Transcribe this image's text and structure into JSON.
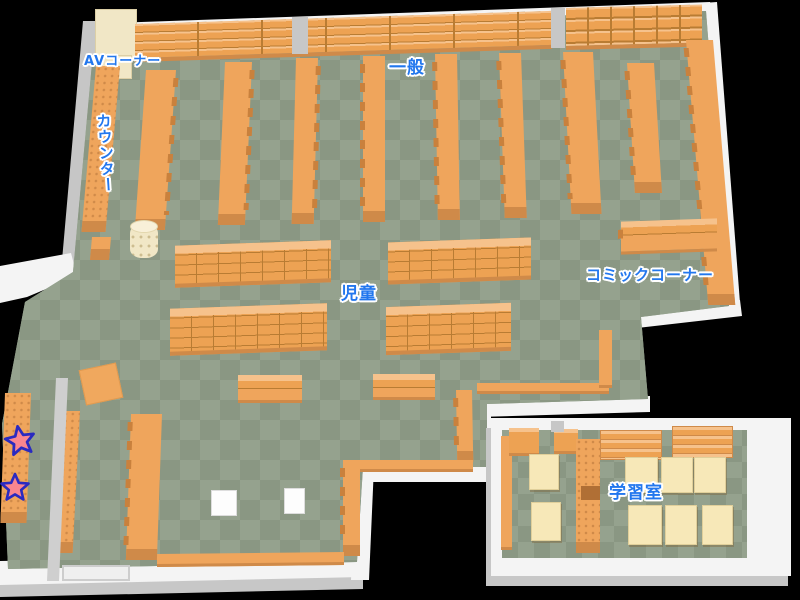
{
  "map": {
    "kind": "library-floor-map",
    "areas": [
      {
        "id": "av-corner",
        "label": "AVコーナー"
      },
      {
        "id": "counter",
        "label": "カウンター"
      },
      {
        "id": "general",
        "label": "一般"
      },
      {
        "id": "children",
        "label": "児童"
      },
      {
        "id": "comic-corner",
        "label": "コミックコーナー"
      },
      {
        "id": "study-room",
        "label": "学習室"
      }
    ],
    "markers": [
      {
        "id": "star-1",
        "icon": "star-icon"
      },
      {
        "id": "star-2",
        "icon": "star-icon"
      }
    ]
  },
  "colors": {
    "bg": "#000000",
    "floor-light": "#95a28e",
    "floor-dark": "#8a9783",
    "shelf": "#efa55c",
    "shelf-face": "#eda253",
    "shelf-top": "#f6c28c",
    "shelf-line": "#b97c33",
    "shelf-dark": "#c9813d",
    "shelf-cap": "#cf8a49",
    "wall-white": "#f4f4f4",
    "wall-gray": "#c7c7c7",
    "label-blue": "#2277ee",
    "desk": "#f7e8b8",
    "counter-beige": "#f1e7c6",
    "star-fill": "#f9868f",
    "star-stroke": "#2a2ac0",
    "divider-notch": "#b06f35"
  }
}
